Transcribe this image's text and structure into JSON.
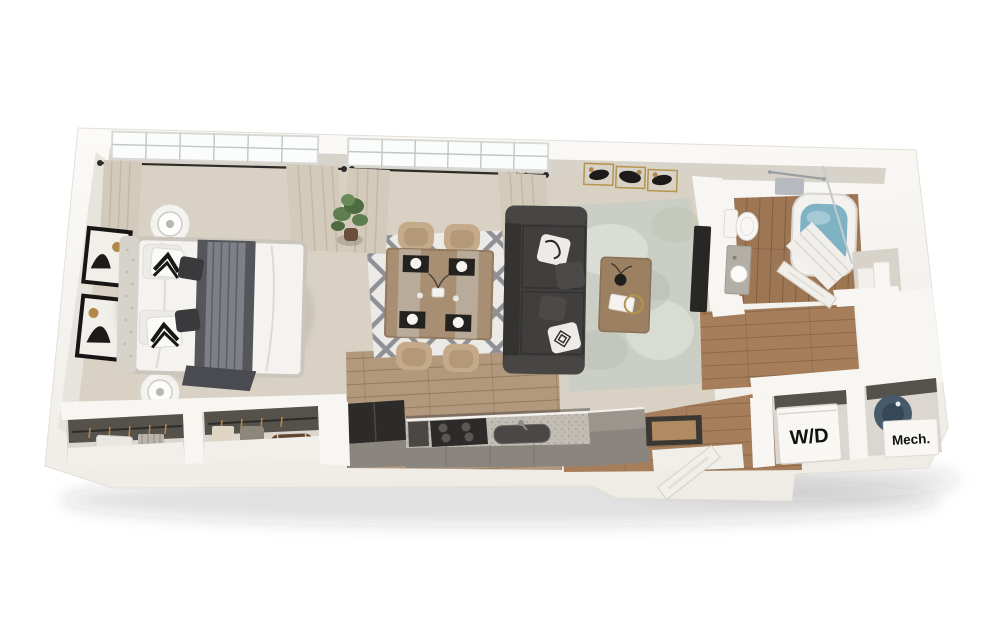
{
  "window": {
    "width": 998,
    "height": 626,
    "background": "#ffffff"
  },
  "floorplan": {
    "kind": "3d-apartment-floor-plan-render",
    "text_labels": {
      "washer_dryer": "W/D",
      "mechanical": "Mech."
    },
    "palette": {
      "wall": "#f7f6f3",
      "wall_shade": "#e7e4de",
      "wall_inner": "#d8d3ca",
      "soft_white": "#f1efe9",
      "carpet": "#d9d2c4",
      "wood": "#b2987c",
      "wood_dark": "#a67e5b",
      "wood_bath": "#9d7654",
      "rug_dining": "#eceae6",
      "rug_trellis": "#6f7176",
      "rug_living": "#cbcec5",
      "sofa": "#403f3e",
      "sofa_shade": "#343332",
      "pillow_white": "#edebe7",
      "blanket": "#55565c",
      "blanket_light": "#7e8088",
      "bed_white": "#f4f3f0",
      "bed_frame": "#cac5bd",
      "chair": "#c4aa8a",
      "chair_seat": "#b3997a",
      "table_wood": "#a88e72",
      "coffee_table": "#9c8062",
      "counter": "#8b8580",
      "countertop": "#c1bdb5",
      "appliance_black": "#2c2b2a",
      "steel": "#4a4846",
      "tub_water": "#7fb2c3",
      "curtain": "#d3cabb",
      "plant": "#5e7e4f",
      "pot": "#6b4f3a",
      "heater": "#475a6b",
      "gold": "#b5954d",
      "rod_black": "#2e2c29",
      "frame_black": "#171615",
      "stone": "#b3aea6",
      "label_ink": "#121212",
      "closet_bg": "#dbd7d0",
      "closet_dark": "#55524c",
      "mat_dark": "#3b3834",
      "mat_wood": "#b08a60"
    },
    "rooms": [
      {
        "name": "bedroom",
        "furniture": [
          "bed",
          "nightstand",
          "table-lamp",
          "wall-art",
          "plant",
          "window",
          "curtains"
        ]
      },
      {
        "name": "dining-area",
        "furniture": [
          "dining-table",
          "dining-chair",
          "trellis-rug",
          "place-setting"
        ]
      },
      {
        "name": "living-area",
        "furniture": [
          "sofa",
          "coffee-table",
          "distressed-rug",
          "tv",
          "triptych-art"
        ]
      },
      {
        "name": "kitchen",
        "furniture": [
          "refrigerator",
          "cooktop",
          "sink",
          "cabinets",
          "peninsula-counter"
        ]
      },
      {
        "name": "bathroom",
        "furniture": [
          "toilet",
          "vanity-sink",
          "bathtub",
          "shower-curtain",
          "towel-bar",
          "linen-shelf"
        ]
      },
      {
        "name": "bedroom-closets",
        "furniture": [
          "hanging-clothes",
          "storage-trunk"
        ]
      },
      {
        "name": "laundry-closet",
        "label_key": "washer_dryer"
      },
      {
        "name": "mechanical-closet",
        "label_key": "mechanical"
      },
      {
        "name": "entry",
        "furniture": [
          "front-door",
          "doormat"
        ]
      }
    ]
  }
}
